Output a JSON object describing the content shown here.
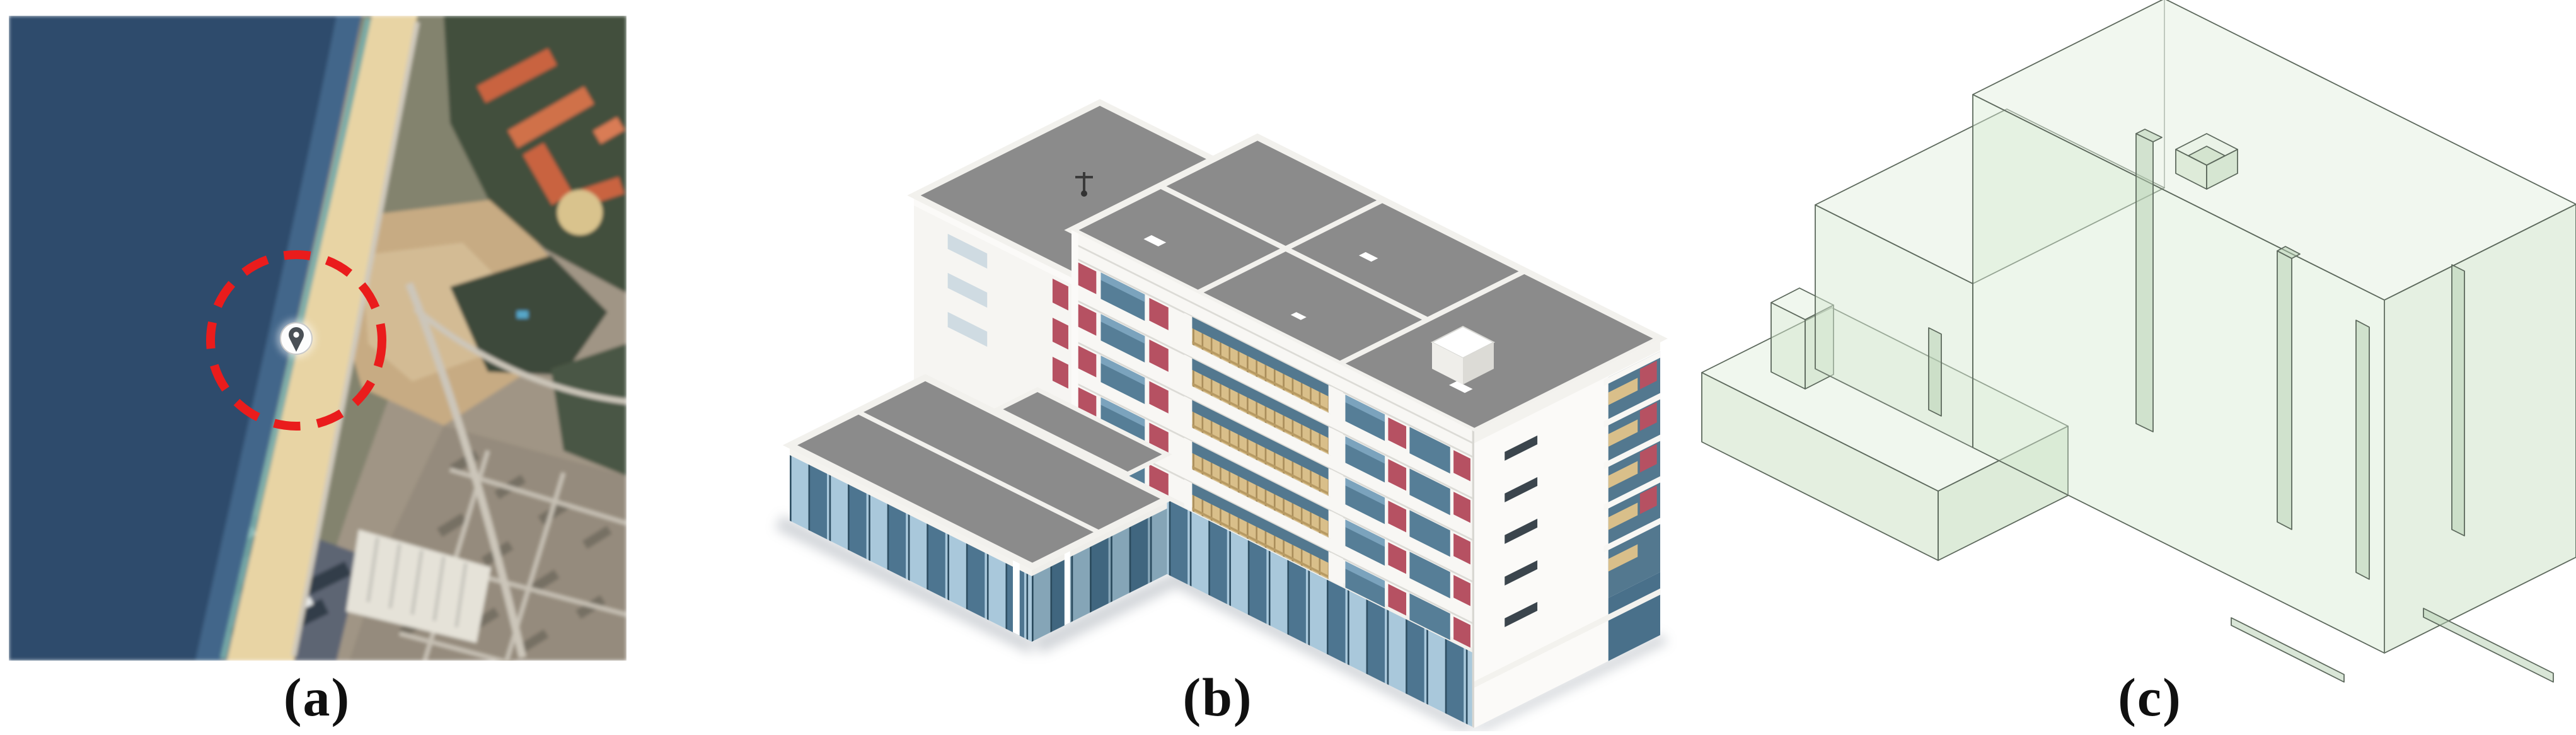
{
  "figure": {
    "background": "#ffffff",
    "panels": [
      {
        "id": "a",
        "label": "(a)",
        "content": "satellite-map-with-site-marker",
        "marker": {
          "kind": "location-pin",
          "highlight": "red-dashed-circle"
        }
      },
      {
        "id": "b",
        "label": "(b)",
        "content": "bim-building-3d-model"
      },
      {
        "id": "c",
        "label": "(c)",
        "content": "simplified-thermal-zone-3d-model"
      }
    ],
    "palette": {
      "ocean_deep": "#2d4b6c",
      "ocean_shallow": "#42668a",
      "surf": "#79b1ae",
      "sand": "#e8d4a4",
      "dirt_site": "#c7ab83",
      "vegetation_dark": "#434f3e",
      "roof_orange": "#c9633f",
      "city_fabric": "#958b7d",
      "dark_towers": "#39434f",
      "marker_red": "#ea1c1c",
      "pin_gray": "#4a5056",
      "bim_roof_gray": "#8b8b8b",
      "bim_wall_white": "#f8f7f4",
      "bim_glass_light": "#a9c8db",
      "bim_glass_dark": "#4d7590",
      "bim_panel_red": "#b65162",
      "bim_railing_tan": "#d9bf8a",
      "zone_fill_green": "#dcead7",
      "zone_edge_green": "#5d695d",
      "label_color": "#101010"
    }
  }
}
